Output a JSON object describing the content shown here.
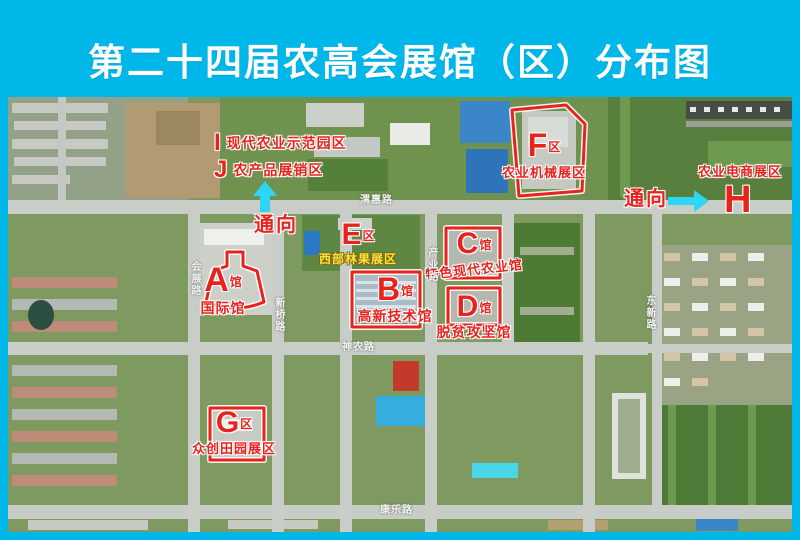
{
  "title": "第二十四届农高会展馆（区）分布图",
  "map": {
    "venues": [
      {
        "id": "A",
        "suffix": "馆",
        "name": "国际馆"
      },
      {
        "id": "B",
        "suffix": "馆",
        "name": "高新技术馆"
      },
      {
        "id": "C",
        "suffix": "馆",
        "name": "特色现代农业馆"
      },
      {
        "id": "D",
        "suffix": "馆",
        "name": "脱贫攻坚馆"
      },
      {
        "id": "E",
        "suffix": "区",
        "name": "西部林果展区"
      },
      {
        "id": "F",
        "suffix": "区",
        "name": "农业机械展区"
      },
      {
        "id": "G",
        "suffix": "区",
        "name": "众创田园展区"
      },
      {
        "id": "H",
        "suffix": "",
        "name": "农业电商展区"
      },
      {
        "id": "I",
        "suffix": "",
        "name": "现代农业示范园区"
      },
      {
        "id": "J",
        "suffix": "",
        "name": "农产品展销区"
      }
    ],
    "connectors": [
      {
        "label": "通向",
        "direction": "up"
      },
      {
        "label": "通向",
        "direction": "right"
      }
    ],
    "roads": [
      {
        "name": "渭惠路",
        "orientation": "horizontal"
      },
      {
        "name": "会展路",
        "orientation": "vertical"
      },
      {
        "name": "新桥路",
        "orientation": "vertical"
      },
      {
        "name": "产业路",
        "orientation": "vertical"
      },
      {
        "name": "神农路",
        "orientation": "horizontal"
      },
      {
        "name": "东新路",
        "orientation": "vertical"
      },
      {
        "name": "康乐路",
        "orientation": "horizontal"
      }
    ],
    "colors": {
      "frame_cyan": "#00b7ea",
      "annotation_red": "#e8231d",
      "arrow_cyan": "#2bd7f5",
      "highlight_yellow": "#ffe23a"
    }
  }
}
